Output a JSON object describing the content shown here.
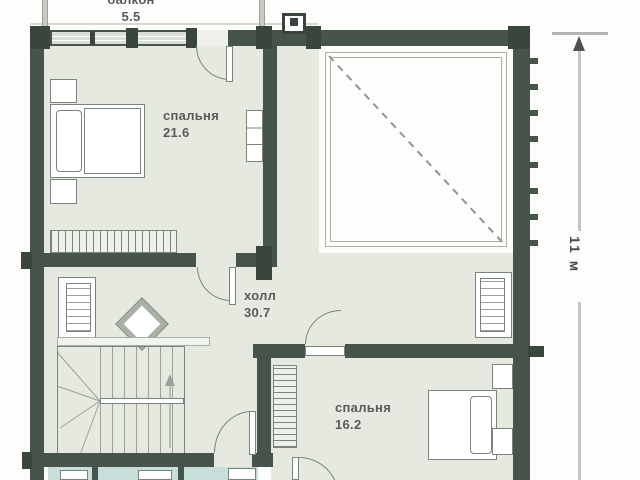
{
  "rooms": {
    "balcony": {
      "name": "балкон",
      "area": "5.5"
    },
    "bedroom_top": {
      "name": "спальня",
      "area": "21.6"
    },
    "hall": {
      "name": "холл",
      "area": "30.7"
    },
    "bedroom_bottom": {
      "name": "спальня",
      "area": "16.2"
    }
  },
  "dimension": {
    "vertical": "11 м"
  },
  "colors": {
    "wall": "#47544b",
    "floor": "#e6e9e0",
    "glass": "#c8dedb",
    "accent_line": "#8d978e"
  }
}
